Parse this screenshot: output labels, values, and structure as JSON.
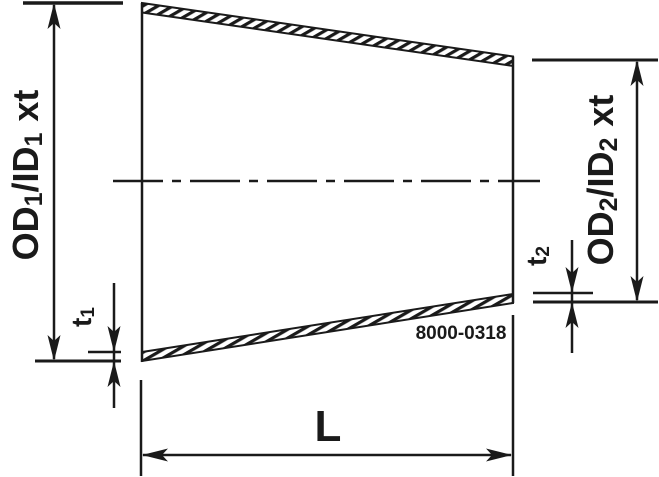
{
  "diagram": {
    "type": "technical-drawing",
    "subject": "concentric-reducer-cross-section",
    "part_number": "8000-0318",
    "labels": {
      "od1": {
        "main1": "OD",
        "sub1": "1",
        "main2": "/ID",
        "sub2": "1",
        "suffix": "xt"
      },
      "od2": {
        "main1": "OD",
        "sub1": "2",
        "main2": "/ID",
        "sub2": "2",
        "suffix": "xt"
      },
      "t1": {
        "main": "t",
        "sub": "1"
      },
      "t2": {
        "main": "t",
        "sub": "2"
      },
      "length": "L"
    },
    "colors": {
      "ink": "#1a1a1a",
      "background": "#ffffff"
    }
  }
}
